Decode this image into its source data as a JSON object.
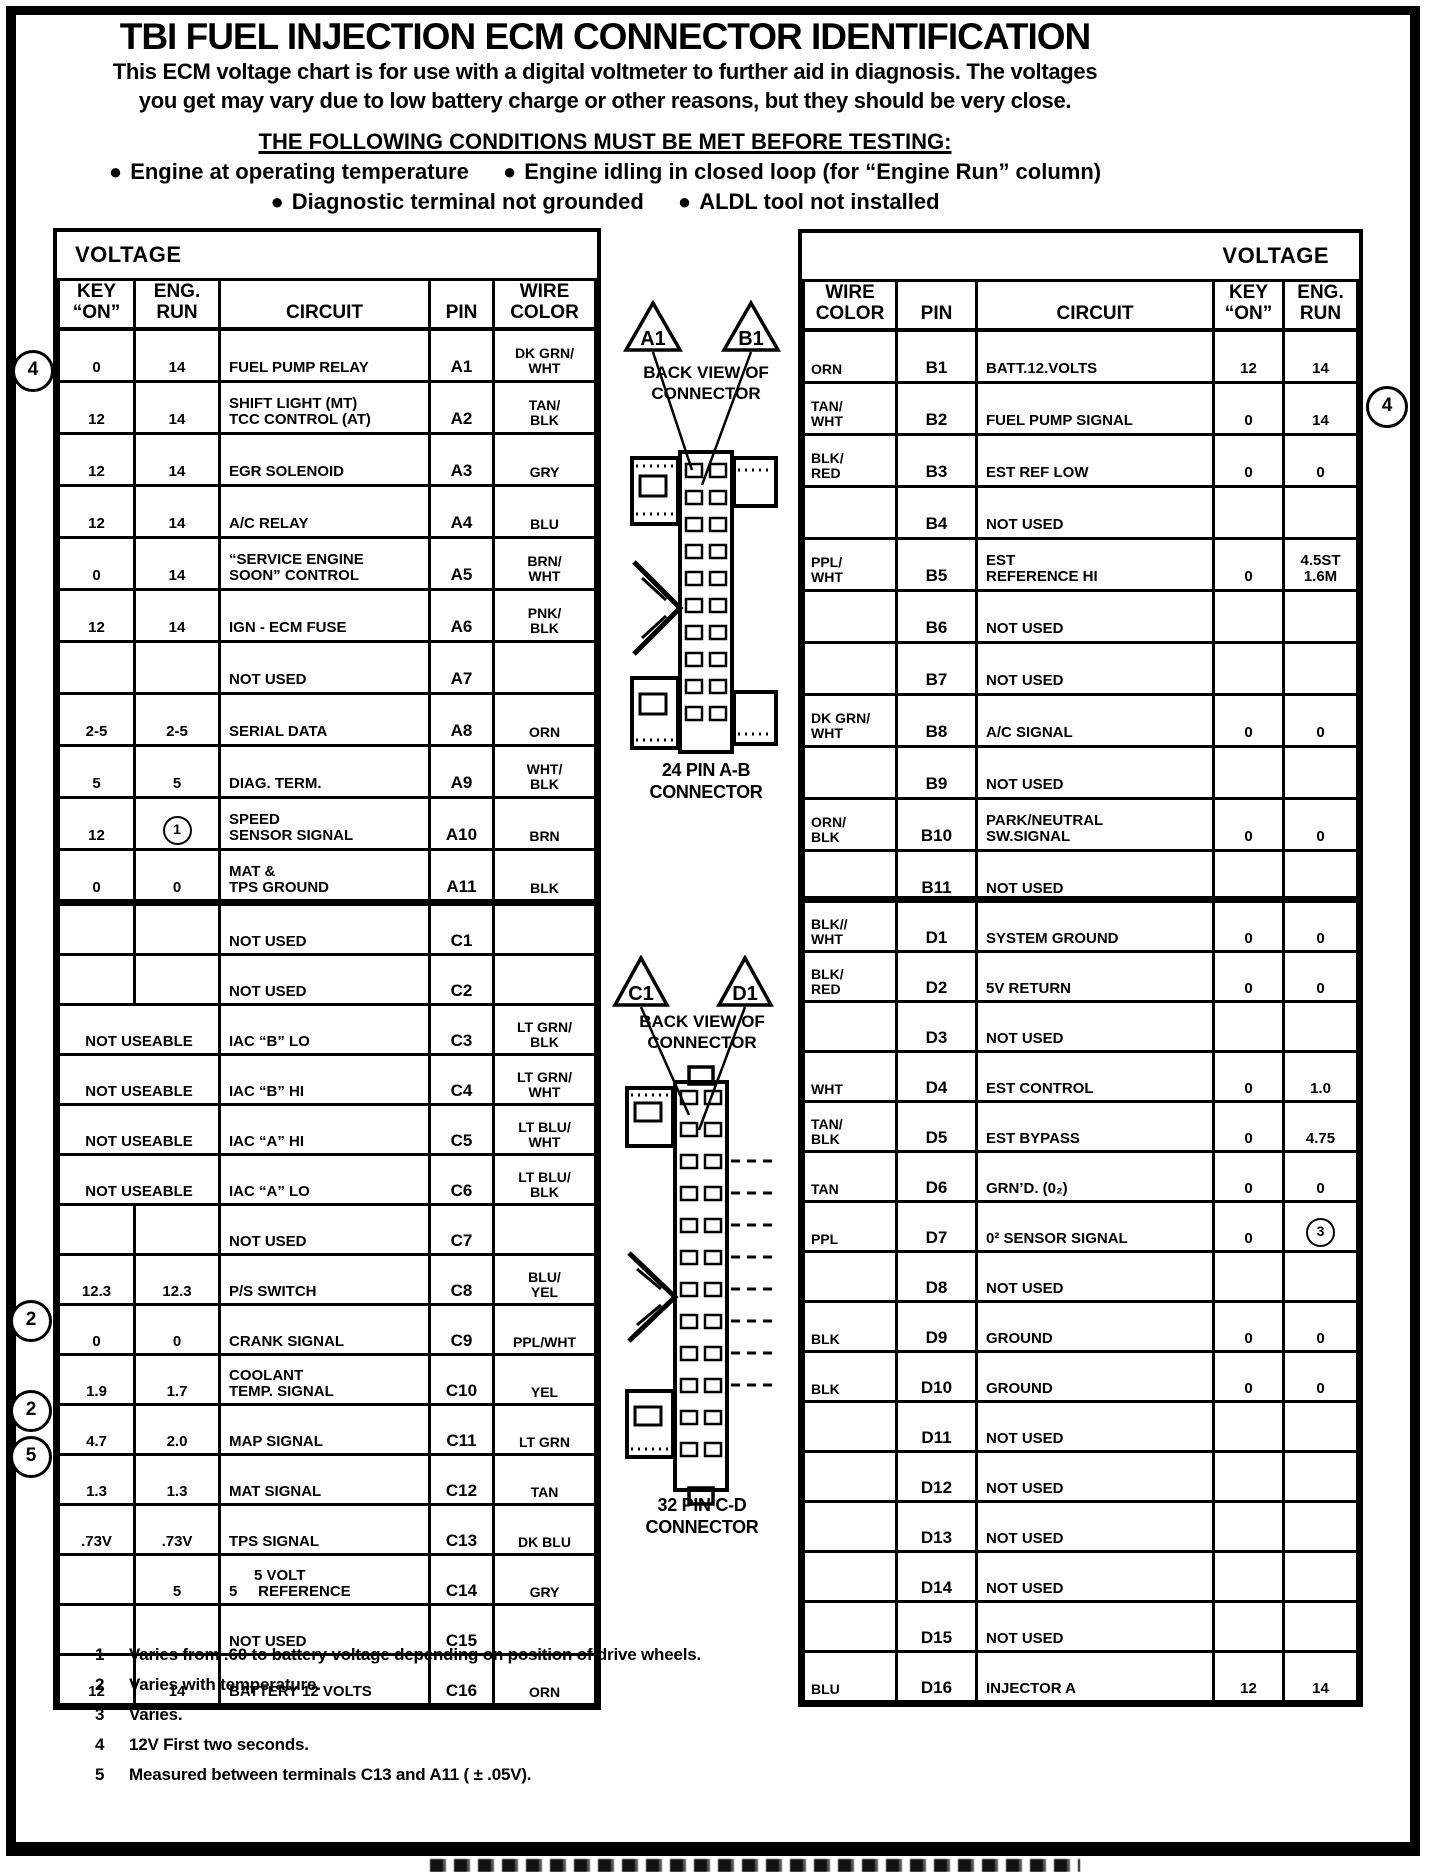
{
  "page": {
    "title": "TBI FUEL INJECTION ECM CONNECTOR IDENTIFICATION",
    "intro_line1": "This ECM voltage chart is for use with a digital voltmeter to further aid in diagnosis.  The voltages",
    "intro_line2": "you get may vary due to low battery charge or other reasons, but they should be very close.",
    "conditions_heading": "THE FOLLOWING CONDITIONS MUST BE MET BEFORE TESTING:",
    "bullet_char": "●",
    "conditions": [
      "Engine at operating temperature",
      "Engine idling in closed loop (for “Engine Run” column)",
      "Diagnostic terminal not grounded",
      "ALDL tool not installed"
    ]
  },
  "labels": {
    "voltage": "VOLTAGE",
    "key_on": "KEY\n“ON”",
    "eng_run": "ENG.\nRUN",
    "circuit": "CIRCUIT",
    "pin": "PIN",
    "wire_color": "WIRE\nCOLOR"
  },
  "connectors": {
    "ab": {
      "pin_a": "A1",
      "pin_b": "B1",
      "back_view": "BACK VIEW\nOF\nCONNECTOR",
      "label": "24 PIN  A-B\nCONNECTOR"
    },
    "cd": {
      "pin_c": "C1",
      "pin_d": "D1",
      "back_view": "BACK VIEW\nOF\nCONNECTOR",
      "label": "32 PIN C-D\nCONNECTOR"
    }
  },
  "annotations": {
    "margin_markers": [
      {
        "value": "4",
        "side": "left",
        "near": "A1"
      },
      {
        "value": "2",
        "side": "left",
        "near": "C10"
      },
      {
        "value": "2",
        "side": "left",
        "near": "C12"
      },
      {
        "value": "5",
        "side": "left",
        "near": "C13"
      },
      {
        "value": "4",
        "side": "right",
        "near": "B2"
      }
    ]
  },
  "tables": {
    "a": {
      "rows": [
        {
          "v1": "0",
          "v2": "14",
          "circuit": "FUEL PUMP RELAY",
          "pin": "A1",
          "wire": "DK GRN/\nWHT"
        },
        {
          "v1": "12",
          "v2": "14",
          "circuit": "SHIFT LIGHT (MT)\nTCC CONTROL (AT)",
          "pin": "A2",
          "wire": "TAN/\nBLK"
        },
        {
          "v1": "12",
          "v2": "14",
          "circuit": "EGR SOLENOID",
          "pin": "A3",
          "wire": "GRY"
        },
        {
          "v1": "12",
          "v2": "14",
          "circuit": "A/C RELAY",
          "pin": "A4",
          "wire": "BLU"
        },
        {
          "v1": "0",
          "v2": "14",
          "circuit": "“SERVICE ENGINE\nSOON” CONTROL",
          "pin": "A5",
          "wire": "BRN/\nWHT"
        },
        {
          "v1": "12",
          "v2": "14",
          "circuit": "IGN - ECM FUSE",
          "pin": "A6",
          "wire": "PNK/\nBLK"
        },
        {
          "v1": "",
          "v2": "",
          "circuit": "NOT USED",
          "pin": "A7",
          "wire": ""
        },
        {
          "v1": "2-5",
          "v2": "2-5",
          "circuit": "SERIAL DATA",
          "pin": "A8",
          "wire": "ORN"
        },
        {
          "v1": "5",
          "v2": "5",
          "circuit": "DIAG. TERM.",
          "pin": "A9",
          "wire": "WHT/\nBLK"
        },
        {
          "v1": "12",
          "v2": "1",
          "v2_circled": true,
          "circuit": "SPEED\nSENSOR SIGNAL",
          "pin": "A10",
          "wire": "BRN"
        },
        {
          "v1": "0",
          "v2": "0",
          "circuit": "MAT &\nTPS GROUND",
          "pin": "A11",
          "wire": "BLK"
        },
        {
          "v1": "0",
          "v2": "0",
          "circuit": "SYSTEM GROUND",
          "pin": "A12",
          "wire": "BLK/\nWHT"
        }
      ]
    },
    "c": {
      "rows": [
        {
          "v1": "",
          "v2": "",
          "circuit": "NOT USED",
          "pin": "C1",
          "wire": ""
        },
        {
          "v1": "",
          "v2": "",
          "circuit": "NOT USED",
          "pin": "C2",
          "wire": ""
        },
        {
          "span2": "NOT USEABLE",
          "circuit": "IAC “B” LO",
          "pin": "C3",
          "wire": "LT GRN/\nBLK"
        },
        {
          "span2": "NOT USEABLE",
          "circuit": "IAC “B” HI",
          "pin": "C4",
          "wire": "LT GRN/\nWHT"
        },
        {
          "span2": "NOT USEABLE",
          "circuit": "IAC “A” HI",
          "pin": "C5",
          "wire": "LT BLU/\nWHT"
        },
        {
          "span2": "NOT USEABLE",
          "circuit": "IAC “A” LO",
          "pin": "C6",
          "wire": "LT BLU/\nBLK"
        },
        {
          "v1": "",
          "v2": "",
          "circuit": "NOT USED",
          "pin": "C7",
          "wire": ""
        },
        {
          "v1": "12.3",
          "v2": "12.3",
          "circuit": "P/S SWITCH",
          "pin": "C8",
          "wire": "BLU/\nYEL"
        },
        {
          "v1": "0",
          "v2": "0",
          "circuit": "CRANK SIGNAL",
          "pin": "C9",
          "wire": "PPL/WHT"
        },
        {
          "v1": "1.9",
          "v2": "1.7",
          "circuit": "COOLANT\nTEMP. SIGNAL",
          "pin": "C10",
          "wire": "YEL"
        },
        {
          "v1": "4.7",
          "v2": "2.0",
          "circuit": "MAP SIGNAL",
          "pin": "C11",
          "wire": "LT GRN"
        },
        {
          "v1": "1.3",
          "v2": "1.3",
          "circuit": "MAT SIGNAL",
          "pin": "C12",
          "wire": "TAN"
        },
        {
          "v1": ".73V",
          "v2": ".73V",
          "circuit": "TPS SIGNAL",
          "pin": "C13",
          "wire": "DK BLU"
        },
        {
          "v1": "",
          "v2": "5",
          "circuit": "      5 VOLT\n5     REFERENCE",
          "pin": "C14",
          "wire": "GRY"
        },
        {
          "v1": "",
          "v2": "",
          "circuit": "NOT USED",
          "pin": "C15",
          "wire": ""
        },
        {
          "v1": "12",
          "v2": "14",
          "circuit": "BATTERY 12 VOLTS",
          "pin": "C16",
          "wire": "ORN"
        }
      ]
    },
    "b": {
      "rows": [
        {
          "wire": "ORN",
          "pin": "B1",
          "circuit": "BATT.12.VOLTS",
          "v1": "12",
          "v2": "14"
        },
        {
          "wire": "TAN/\nWHT",
          "pin": "B2",
          "circuit": "FUEL PUMP SIGNAL",
          "v1": "0",
          "v2": "14"
        },
        {
          "wire": "BLK/\nRED",
          "pin": "B3",
          "circuit": "EST REF LOW",
          "v1": "0",
          "v2": "0"
        },
        {
          "wire": "",
          "pin": "B4",
          "circuit": "NOT USED",
          "v1": "",
          "v2": ""
        },
        {
          "wire": "PPL/\nWHT",
          "pin": "B5",
          "circuit": "EST\nREFERENCE HI",
          "v1": "0",
          "v2": "4.5ST\n1.6M"
        },
        {
          "wire": "",
          "pin": "B6",
          "circuit": "NOT USED",
          "v1": "",
          "v2": ""
        },
        {
          "wire": "",
          "pin": "B7",
          "circuit": "NOT USED",
          "v1": "",
          "v2": ""
        },
        {
          "wire": "DK GRN/\nWHT",
          "pin": "B8",
          "circuit": "A/C SIGNAL",
          "v1": "0",
          "v2": "0"
        },
        {
          "wire": "",
          "pin": "B9",
          "circuit": "NOT USED",
          "v1": "",
          "v2": ""
        },
        {
          "wire": "ORN/\nBLK",
          "pin": "B10",
          "circuit": "PARK/NEUTRAL\nSW.SIGNAL",
          "v1": "0",
          "v2": "0"
        },
        {
          "wire": "",
          "pin": "B11",
          "circuit": "NOT USED",
          "v1": "",
          "v2": ""
        },
        {
          "wire": "",
          "pin": "B12",
          "circuit": "NOT USED",
          "v1": "",
          "v2": ""
        }
      ]
    },
    "d": {
      "rows": [
        {
          "wire": "BLK//\nWHT",
          "pin": "D1",
          "circuit": "SYSTEM GROUND",
          "v1": "0",
          "v2": "0"
        },
        {
          "wire": "BLK/\nRED",
          "pin": "D2",
          "circuit": "5V RETURN",
          "v1": "0",
          "v2": "0"
        },
        {
          "wire": "",
          "pin": "D3",
          "circuit": "NOT USED",
          "v1": "",
          "v2": ""
        },
        {
          "wire": "WHT",
          "pin": "D4",
          "circuit": "EST CONTROL",
          "v1": "0",
          "v2": "1.0"
        },
        {
          "wire": "TAN/\nBLK",
          "pin": "D5",
          "circuit": "EST BYPASS",
          "v1": "0",
          "v2": "4.75"
        },
        {
          "wire": "TAN",
          "pin": "D6",
          "circuit": "GRN’D. (0₂)",
          "v1": "0",
          "v2": "0"
        },
        {
          "wire": "PPL",
          "pin": "D7",
          "circuit": "0² SENSOR SIGNAL",
          "v1": "0",
          "v2": "3",
          "v2_circled": true
        },
        {
          "wire": "",
          "pin": "D8",
          "circuit": "NOT USED",
          "v1": "",
          "v2": ""
        },
        {
          "wire": "BLK",
          "pin": "D9",
          "circuit": "GROUND",
          "v1": "0",
          "v2": "0"
        },
        {
          "wire": "BLK",
          "pin": "D10",
          "circuit": "GROUND",
          "v1": "0",
          "v2": "0"
        },
        {
          "wire": "",
          "pin": "D11",
          "circuit": "NOT USED",
          "v1": "",
          "v2": ""
        },
        {
          "wire": "",
          "pin": "D12",
          "circuit": "NOT USED",
          "v1": "",
          "v2": ""
        },
        {
          "wire": "",
          "pin": "D13",
          "circuit": "NOT USED",
          "v1": "",
          "v2": ""
        },
        {
          "wire": "",
          "pin": "D14",
          "circuit": "NOT USED",
          "v1": "",
          "v2": ""
        },
        {
          "wire": "",
          "pin": "D15",
          "circuit": "NOT USED",
          "v1": "",
          "v2": ""
        },
        {
          "wire": "BLU",
          "pin": "D16",
          "circuit": "INJECTOR A",
          "v1": "12",
          "v2": "14"
        }
      ]
    }
  },
  "footnotes": [
    {
      "num": "1",
      "text": "Varies from .60 to battery voltage depending on position of drive wheels."
    },
    {
      "num": "2",
      "text": "Varies with temperature."
    },
    {
      "num": "3",
      "text": "Varies."
    },
    {
      "num": "4",
      "text": "12V First two seconds."
    },
    {
      "num": "5",
      "text": "Measured between terminals C13 and A11 ( ± .05V)."
    }
  ]
}
